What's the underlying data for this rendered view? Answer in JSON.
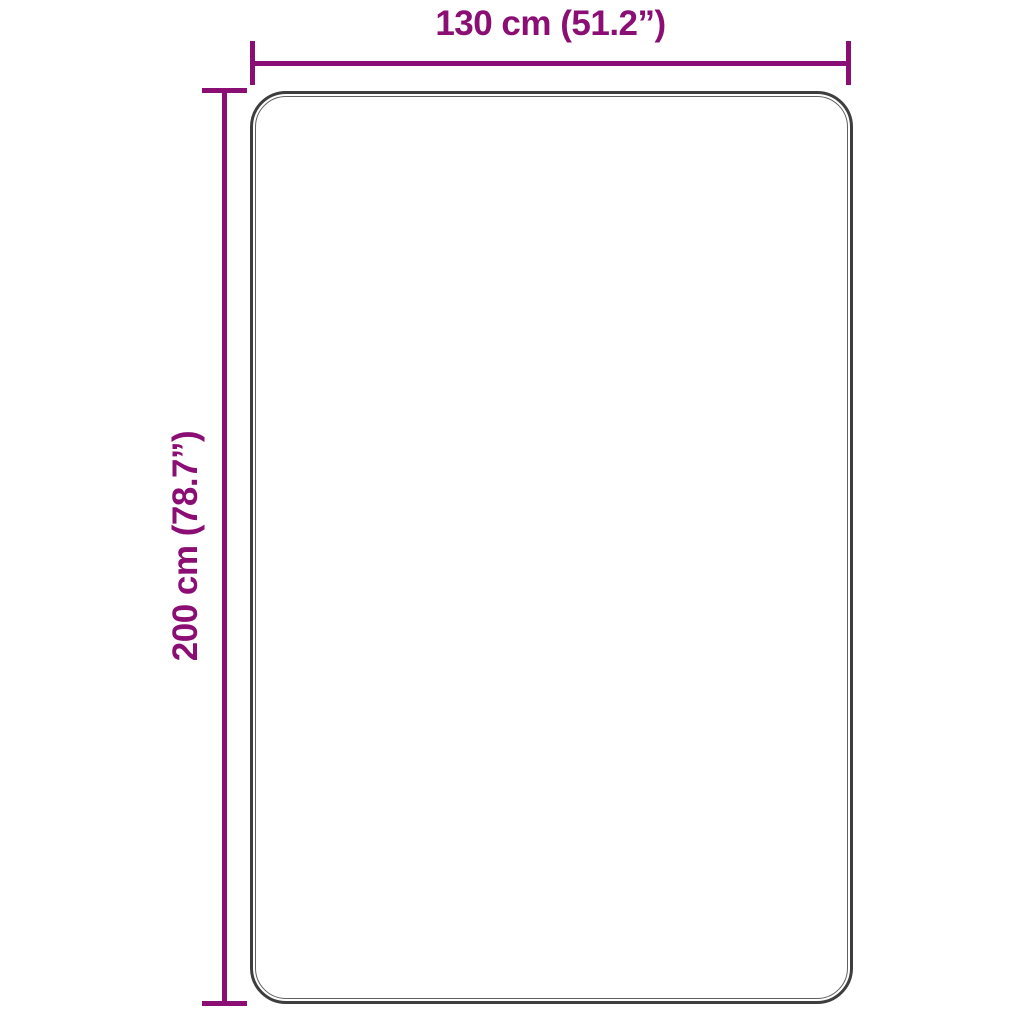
{
  "diagram": {
    "type": "product-dimension-diagram",
    "width_label": "130 cm (51.2”)",
    "height_label": "200 cm (78.7”)",
    "width_value_cm": 130,
    "width_value_inch": 51.2,
    "height_value_cm": 200,
    "height_value_inch": 78.7,
    "colors": {
      "accent": "#8a0e73",
      "outline_outer": "#3e3e3e",
      "outline_inner": "#606060",
      "background": "#ffffff"
    }
  }
}
